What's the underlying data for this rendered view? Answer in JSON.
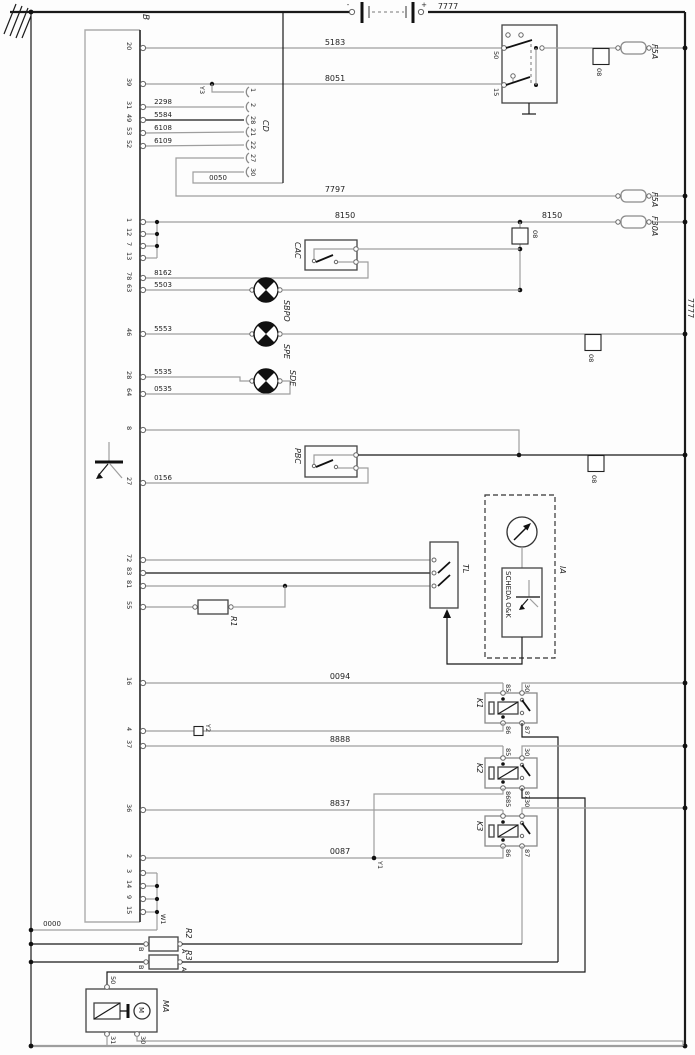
{
  "power": {
    "battery_minus": "-",
    "battery_plus": "+",
    "wire_7777_top": "7777",
    "bus_7777_side": "7777"
  },
  "ignition_switch": {
    "pin_50": "50",
    "pin_15": "15"
  },
  "fuses": {
    "f5a_top": "F5A",
    "f5a_mid": "F5A",
    "f30a": "F30A"
  },
  "ground_square_label": "08",
  "junctions": {
    "y1": "Y1",
    "y2": "Y2",
    "y3": "Y3",
    "w1": "W1"
  },
  "connector_b": {
    "label": "B",
    "pins": {
      "p20": "20",
      "p39": "39",
      "p31": "31",
      "p49": "49",
      "p53": "53",
      "p52": "52",
      "p1": "1",
      "p12": "12",
      "p7": "7",
      "p13": "13",
      "p78": "78",
      "p63": "63",
      "p46": "46",
      "p28": "28",
      "p64": "64",
      "p8": "8",
      "p27": "27",
      "p72": "72",
      "p83": "83",
      "p81": "81",
      "p55": "55",
      "p16": "16",
      "p4": "4",
      "p37": "37",
      "p36": "36",
      "p2": "2",
      "p3": "3",
      "p14": "14",
      "p9": "9",
      "p15": "15"
    }
  },
  "connector_cd": {
    "label": "CD",
    "pins": {
      "a": "1",
      "b": "2",
      "c": "28",
      "d": "21",
      "e": "22",
      "f": "27",
      "g": "30"
    }
  },
  "wire_numbers": {
    "w5183": "5183",
    "w8051": "8051",
    "w2298": "2298",
    "w5584": "5584",
    "w6108": "6108",
    "w6109": "6109",
    "w0050": "0050",
    "w7797": "7797",
    "w8150": "8150",
    "w8162": "8162",
    "w5503": "5503",
    "w5553": "5553",
    "w5535": "5535",
    "w0535": "0535",
    "w0156": "0156",
    "w0094": "0094",
    "w8888": "8888",
    "w8837": "8837",
    "w0087": "0087",
    "w0000": "0000"
  },
  "components": {
    "cac": "CAC",
    "sbpo": "SBPO",
    "spe": "SPE",
    "sde": "SDE",
    "pbc": "PBC",
    "tl": "TL",
    "ia": "IA",
    "scheda": "SCHEDA  O&K",
    "r1": "R1",
    "r2": "R2",
    "r3": "R3",
    "ma": "MA",
    "motor_m": "M"
  },
  "relays": {
    "k1": "K1",
    "k2": "K2",
    "k3": "K3",
    "pin_85": "85",
    "pin_86": "86",
    "pin_30": "30",
    "pin_87": "87"
  },
  "resistor_terminals": {
    "a": "A",
    "b": "B"
  },
  "starter_pins": {
    "p50": "50",
    "p31": "31",
    "p30": "30"
  },
  "colors": {
    "wire_gray": "#9e9e9e",
    "wire_black": "#1a1a1a",
    "frame_gray": "#aaaaaa"
  }
}
